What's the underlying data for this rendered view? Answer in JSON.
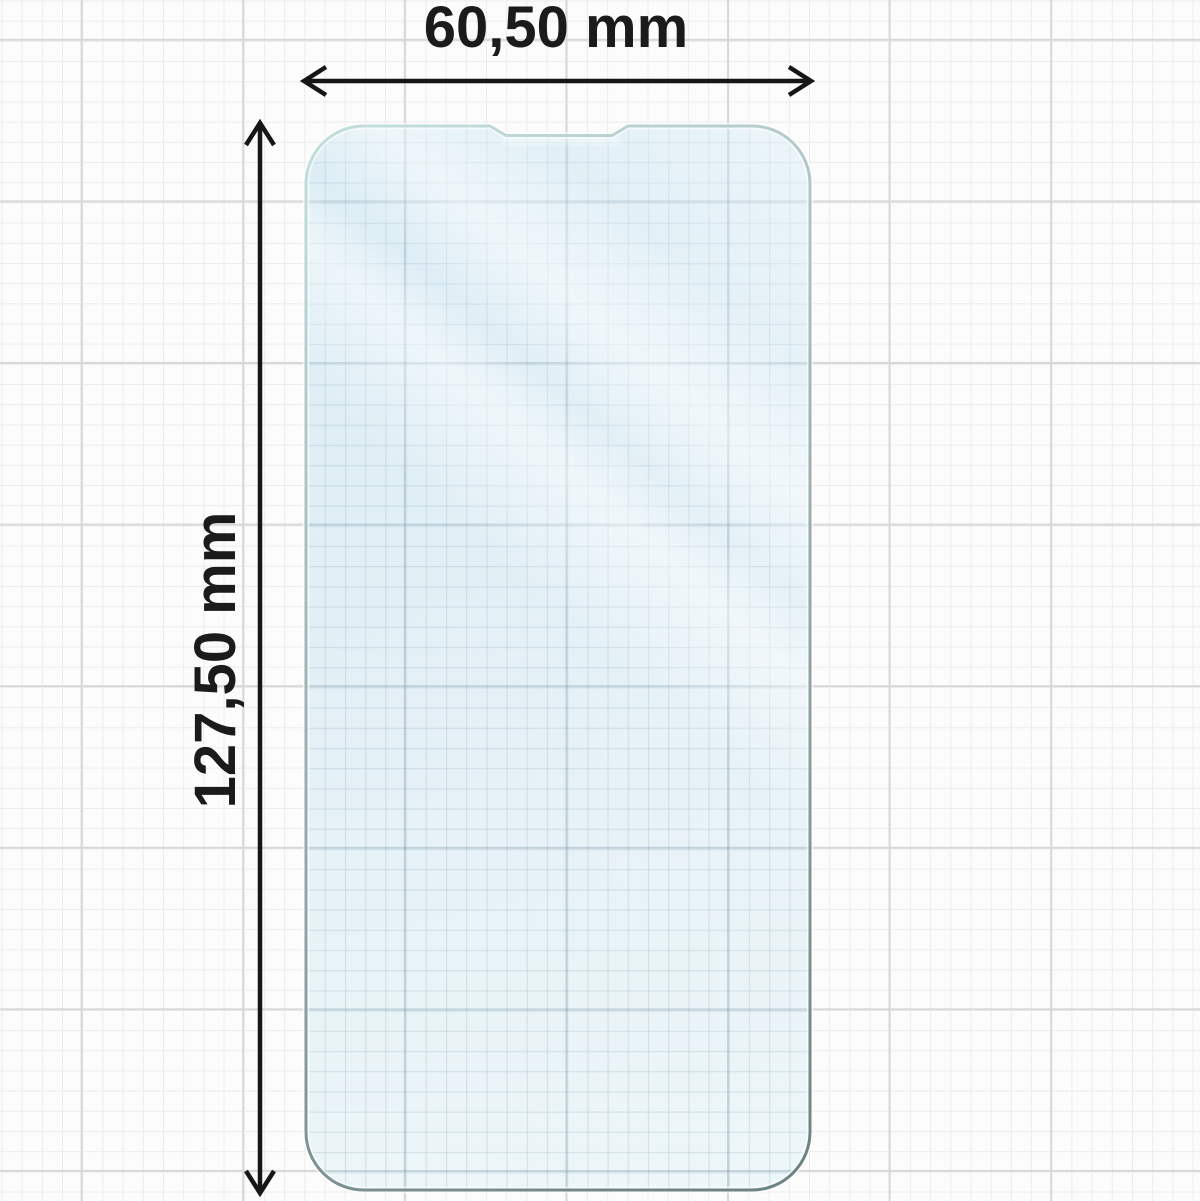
{
  "diagram": {
    "type": "screen-protector-dimension-diagram",
    "subject": "transparent hydrogel screen protector on graph paper",
    "width_label": "60,50 mm",
    "height_label": "127,50 mm"
  },
  "icons": {
    "horizontal_arrow": "double-headed-arrow-left-right",
    "vertical_arrow": "double-headed-arrow-up-down"
  },
  "colors": {
    "background": "#fcfcfc",
    "grid-minor": "#ececee",
    "grid-major": "#d8d8db",
    "arrow": "#161616",
    "label": "#1b1b1b",
    "protector-fill-top": "#d8ebf4",
    "protector-fill-bottom": "#edf6f8",
    "protector-edge-light": "#c2dedb",
    "protector-edge-mid": "#9eafb2",
    "protector-edge-dark": "#6d8384"
  }
}
